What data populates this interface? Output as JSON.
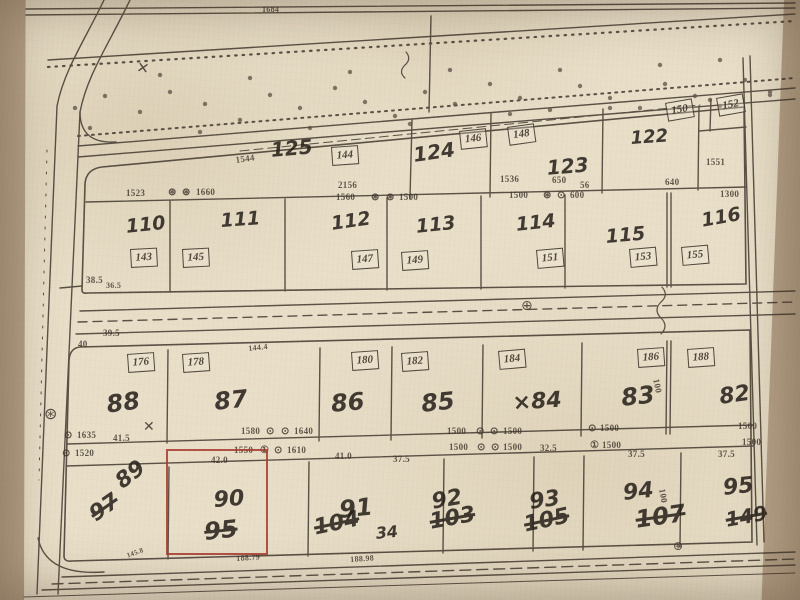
{
  "colors": {
    "photo": "#b4a086",
    "paper": "#e9dfc9",
    "ink": "#3c332a",
    "pen": "#241e18",
    "red": "#a8392e"
  },
  "map": {
    "parcel_numbers": [
      {
        "label": "125",
        "x": 270,
        "y": 140,
        "size": 20,
        "rot": -5
      },
      {
        "label": "124",
        "x": 412,
        "y": 145,
        "size": 20,
        "rot": -8
      },
      {
        "label": "123",
        "x": 546,
        "y": 158,
        "size": 20,
        "rot": -5
      },
      {
        "label": "122",
        "x": 630,
        "y": 130,
        "size": 18,
        "rot": -4
      },
      {
        "label": "110",
        "x": 125,
        "y": 218,
        "size": 19,
        "rot": -6
      },
      {
        "label": "111",
        "x": 220,
        "y": 212,
        "size": 19,
        "rot": -4
      },
      {
        "label": "112",
        "x": 330,
        "y": 215,
        "size": 19,
        "rot": -8
      },
      {
        "label": "113",
        "x": 415,
        "y": 218,
        "size": 19,
        "rot": -6
      },
      {
        "label": "114",
        "x": 515,
        "y": 216,
        "size": 19,
        "rot": -6
      },
      {
        "label": "115",
        "x": 605,
        "y": 228,
        "size": 19,
        "rot": -5
      },
      {
        "label": "116",
        "x": 700,
        "y": 212,
        "size": 19,
        "rot": -10
      },
      {
        "label": "88",
        "x": 105,
        "y": 393,
        "size": 24,
        "rot": -8
      },
      {
        "label": "87",
        "x": 213,
        "y": 390,
        "size": 24,
        "rot": -6
      },
      {
        "label": "86",
        "x": 330,
        "y": 392,
        "size": 24,
        "rot": -5
      },
      {
        "label": "85",
        "x": 420,
        "y": 392,
        "size": 24,
        "rot": -6
      },
      {
        "label": "×84",
        "x": 512,
        "y": 393,
        "size": 22,
        "rot": -4
      },
      {
        "label": "83",
        "x": 620,
        "y": 386,
        "size": 24,
        "rot": -6
      },
      {
        "label": "82",
        "x": 718,
        "y": 387,
        "size": 22,
        "rot": -8
      },
      {
        "label": "89",
        "x": 112,
        "y": 476,
        "size": 22,
        "rot": -38
      },
      {
        "label": "90",
        "x": 213,
        "y": 490,
        "size": 22,
        "rot": -4
      },
      {
        "label": "91",
        "x": 338,
        "y": 498,
        "size": 24,
        "rot": -6
      },
      {
        "label": "92",
        "x": 430,
        "y": 492,
        "size": 22,
        "rot": -10
      },
      {
        "label": "93",
        "x": 528,
        "y": 492,
        "size": 22,
        "rot": -8
      },
      {
        "label": "94",
        "x": 622,
        "y": 483,
        "size": 22,
        "rot": -6
      },
      {
        "label": "95",
        "x": 722,
        "y": 478,
        "size": 22,
        "rot": -6
      }
    ],
    "secondary_numbers": [
      {
        "label": "97",
        "x": 86,
        "y": 508,
        "size": 22,
        "rot": -35,
        "strike": true
      },
      {
        "label": "95",
        "x": 203,
        "y": 520,
        "size": 24,
        "rot": -6,
        "strike": true
      },
      {
        "label": "104",
        "x": 312,
        "y": 518,
        "size": 22,
        "rot": -12,
        "strike": true
      },
      {
        "label": "34",
        "x": 375,
        "y": 526,
        "size": 16,
        "rot": -6
      },
      {
        "label": "103",
        "x": 428,
        "y": 512,
        "size": 22,
        "rot": -10,
        "strike": true
      },
      {
        "label": "105",
        "x": 522,
        "y": 515,
        "size": 22,
        "rot": -12,
        "strike": true
      },
      {
        "label": "107",
        "x": 634,
        "y": 508,
        "size": 24,
        "rot": -8,
        "strike": true
      },
      {
        "label": "149",
        "x": 724,
        "y": 510,
        "size": 20,
        "rot": -10,
        "strike": true
      }
    ],
    "boxed_numbers": [
      {
        "label": "144",
        "x": 331,
        "y": 147,
        "rot": -4
      },
      {
        "label": "146",
        "x": 459,
        "y": 131,
        "rot": -6
      },
      {
        "label": "148",
        "x": 507,
        "y": 127,
        "rot": -8
      },
      {
        "label": "150",
        "x": 665,
        "y": 103,
        "rot": -10
      },
      {
        "label": "152",
        "x": 716,
        "y": 98,
        "rot": -10
      },
      {
        "label": "143",
        "x": 130,
        "y": 249,
        "rot": -3
      },
      {
        "label": "145",
        "x": 182,
        "y": 249,
        "rot": -3
      },
      {
        "label": "147",
        "x": 351,
        "y": 251,
        "rot": -4
      },
      {
        "label": "149",
        "x": 401,
        "y": 252,
        "rot": -4
      },
      {
        "label": "151",
        "x": 536,
        "y": 250,
        "rot": -5
      },
      {
        "label": "153",
        "x": 629,
        "y": 249,
        "rot": -5
      },
      {
        "label": "155",
        "x": 681,
        "y": 247,
        "rot": -5
      },
      {
        "label": "176",
        "x": 127,
        "y": 354,
        "rot": -4
      },
      {
        "label": "178",
        "x": 182,
        "y": 354,
        "rot": -4
      },
      {
        "label": "180",
        "x": 351,
        "y": 352,
        "rot": -4
      },
      {
        "label": "182",
        "x": 401,
        "y": 353,
        "rot": -4
      },
      {
        "label": "184",
        "x": 498,
        "y": 351,
        "rot": -5
      },
      {
        "label": "186",
        "x": 637,
        "y": 349,
        "rot": -4
      },
      {
        "label": "188",
        "x": 687,
        "y": 349,
        "rot": -4
      }
    ],
    "measurements": [
      {
        "label": "1684",
        "x": 262,
        "y": 6,
        "size": 8
      },
      {
        "label": "1544",
        "x": 235,
        "y": 156,
        "size": 9,
        "rot": -8
      },
      {
        "label": "2156",
        "x": 338,
        "y": 181,
        "size": 9
      },
      {
        "label": "1536",
        "x": 500,
        "y": 175,
        "size": 9
      },
      {
        "label": "650",
        "x": 552,
        "y": 176,
        "size": 9
      },
      {
        "label": "56",
        "x": 580,
        "y": 181,
        "size": 9
      },
      {
        "label": "640",
        "x": 665,
        "y": 178,
        "size": 9
      },
      {
        "label": "1551",
        "x": 706,
        "y": 158,
        "size": 9
      },
      {
        "label": "1300",
        "x": 720,
        "y": 190,
        "size": 9
      },
      {
        "label": "1523",
        "x": 126,
        "y": 189,
        "size": 9
      },
      {
        "label": "⊛",
        "x": 168,
        "y": 188,
        "size": 10
      },
      {
        "label": "⊛",
        "x": 182,
        "y": 188,
        "size": 10
      },
      {
        "label": "1660",
        "x": 196,
        "y": 188,
        "size": 9
      },
      {
        "label": "1560",
        "x": 336,
        "y": 193,
        "size": 9
      },
      {
        "label": "⊛",
        "x": 371,
        "y": 193,
        "size": 10
      },
      {
        "label": "⊛",
        "x": 386,
        "y": 193,
        "size": 10
      },
      {
        "label": "1500",
        "x": 399,
        "y": 193,
        "size": 9
      },
      {
        "label": "1500",
        "x": 509,
        "y": 191,
        "size": 9
      },
      {
        "label": "⊛",
        "x": 543,
        "y": 191,
        "size": 10
      },
      {
        "label": "⊙",
        "x": 557,
        "y": 191,
        "size": 10
      },
      {
        "label": "600",
        "x": 570,
        "y": 191,
        "size": 9
      },
      {
        "label": "38.5",
        "x": 86,
        "y": 276,
        "size": 9
      },
      {
        "label": "36.5",
        "x": 106,
        "y": 282,
        "size": 8
      },
      {
        "label": "39.5",
        "x": 103,
        "y": 329,
        "size": 9
      },
      {
        "label": "40",
        "x": 78,
        "y": 340,
        "size": 9
      },
      {
        "label": "144.4",
        "x": 248,
        "y": 345,
        "size": 8,
        "rot": -6
      },
      {
        "label": "⊙",
        "x": 64,
        "y": 431,
        "size": 10
      },
      {
        "label": "1635",
        "x": 77,
        "y": 431,
        "size": 9
      },
      {
        "label": "41.5",
        "x": 113,
        "y": 434,
        "size": 9
      },
      {
        "label": "1580",
        "x": 241,
        "y": 427,
        "size": 9
      },
      {
        "label": "⊙",
        "x": 266,
        "y": 427,
        "size": 10
      },
      {
        "label": "⊙",
        "x": 281,
        "y": 427,
        "size": 10
      },
      {
        "label": "1640",
        "x": 294,
        "y": 427,
        "size": 9
      },
      {
        "label": "1500",
        "x": 447,
        "y": 427,
        "size": 9
      },
      {
        "label": "⊙",
        "x": 476,
        "y": 427,
        "size": 10
      },
      {
        "label": "⊙",
        "x": 490,
        "y": 427,
        "size": 10
      },
      {
        "label": "1500",
        "x": 503,
        "y": 427,
        "size": 9
      },
      {
        "label": "⊙",
        "x": 588,
        "y": 424,
        "size": 10
      },
      {
        "label": "1500",
        "x": 600,
        "y": 424,
        "size": 9
      },
      {
        "label": "1500",
        "x": 738,
        "y": 422,
        "size": 9
      },
      {
        "label": "⊙",
        "x": 62,
        "y": 449,
        "size": 10
      },
      {
        "label": "1520",
        "x": 75,
        "y": 449,
        "size": 9
      },
      {
        "label": "1550",
        "x": 234,
        "y": 446,
        "size": 9
      },
      {
        "label": "①",
        "x": 260,
        "y": 446,
        "size": 10
      },
      {
        "label": "⊙",
        "x": 274,
        "y": 446,
        "size": 10
      },
      {
        "label": "1610",
        "x": 287,
        "y": 446,
        "size": 9
      },
      {
        "label": "42.0",
        "x": 211,
        "y": 456,
        "size": 9
      },
      {
        "label": "41.0",
        "x": 335,
        "y": 452,
        "size": 9
      },
      {
        "label": "37.5",
        "x": 393,
        "y": 455,
        "size": 9
      },
      {
        "label": "1500",
        "x": 449,
        "y": 443,
        "size": 9
      },
      {
        "label": "⊙",
        "x": 477,
        "y": 443,
        "size": 10
      },
      {
        "label": "⊙",
        "x": 491,
        "y": 443,
        "size": 10
      },
      {
        "label": "1500",
        "x": 503,
        "y": 443,
        "size": 9
      },
      {
        "label": "32.5",
        "x": 540,
        "y": 444,
        "size": 9
      },
      {
        "label": "①",
        "x": 590,
        "y": 441,
        "size": 10
      },
      {
        "label": "1500",
        "x": 602,
        "y": 441,
        "size": 9
      },
      {
        "label": "37.5",
        "x": 628,
        "y": 450,
        "size": 9
      },
      {
        "label": "37.5",
        "x": 718,
        "y": 450,
        "size": 9
      },
      {
        "label": "1500",
        "x": 742,
        "y": 438,
        "size": 9
      },
      {
        "label": "100",
        "x": 660,
        "y": 378,
        "size": 9,
        "rot": 78
      },
      {
        "label": "100",
        "x": 666,
        "y": 488,
        "size": 9,
        "rot": 80
      },
      {
        "label": "145.8",
        "x": 126,
        "y": 553,
        "size": 7,
        "rot": -20
      },
      {
        "label": "188.79",
        "x": 236,
        "y": 555,
        "size": 8,
        "rot": -4
      },
      {
        "label": "188.98",
        "x": 350,
        "y": 556,
        "size": 8,
        "rot": -4
      }
    ],
    "symbols": [
      {
        "name": "gear-symbol",
        "label": "⊛",
        "x": 44,
        "y": 406,
        "size": 16
      },
      {
        "name": "circle-plus-symbol",
        "label": "⊕",
        "x": 521,
        "y": 299,
        "size": 14
      },
      {
        "name": "circle-plus-symbol",
        "label": "⊕",
        "x": 673,
        "y": 540,
        "size": 12
      },
      {
        "name": "x-mark",
        "label": "✕",
        "x": 138,
        "y": 60,
        "size": 15,
        "rot": 10
      },
      {
        "name": "x-mark",
        "label": "✕",
        "x": 143,
        "y": 420,
        "size": 14
      }
    ]
  }
}
